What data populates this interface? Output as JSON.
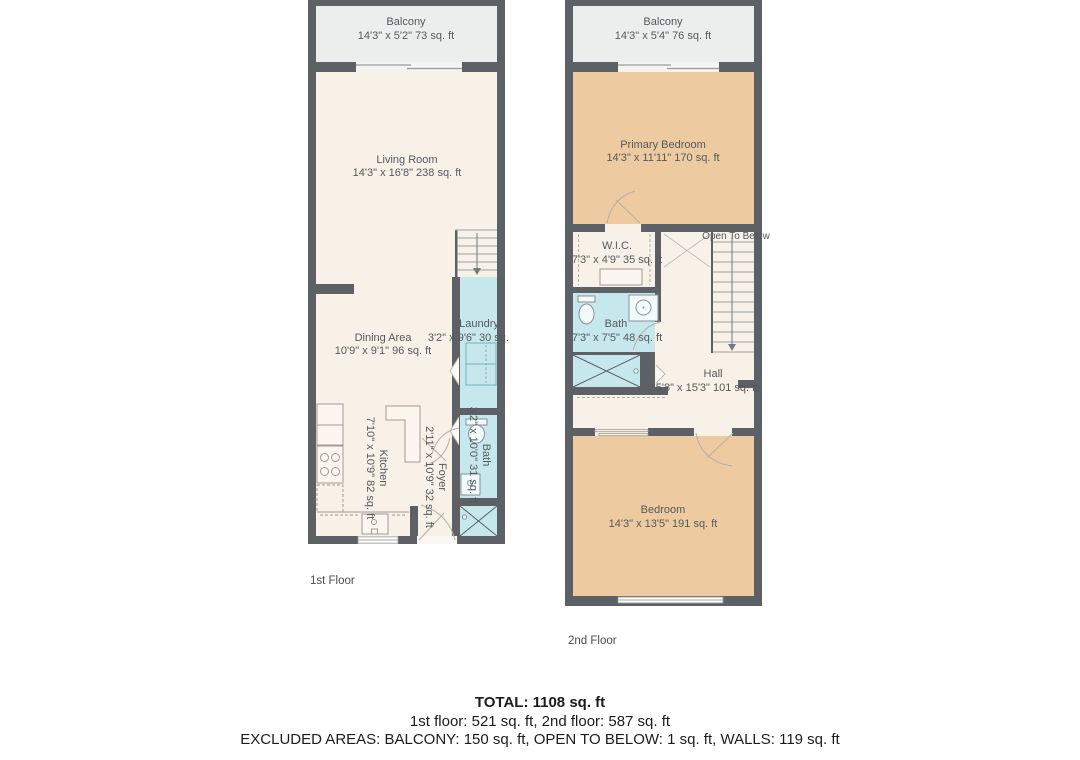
{
  "floors": {
    "first": {
      "caption": "1st Floor",
      "rooms": {
        "balcony": {
          "name": "Balcony",
          "dims": "14'3\" x 5'2\" 73 sq. ft"
        },
        "living": {
          "name": "Living Room",
          "dims": "14'3\" x 16'8\" 238 sq. ft"
        },
        "dining": {
          "name": "Dining Area",
          "dims": "10'9\" x 9'1\" 96 sq. ft"
        },
        "kitchen": {
          "name": "Kitchen",
          "dims": "7'10\" x 10'9\" 82 sq. ft"
        },
        "laundry": {
          "name": "Laundry",
          "dims": "3'2\" x 9'6\" 30 sq. ft"
        },
        "foyer": {
          "name": "Foyer",
          "dims": "2'11\" x 10'9\" 32 sq. ft"
        },
        "bath": {
          "name": "Bath",
          "dims": "3'2\" x 10'0\" 31 sq. ft"
        }
      }
    },
    "second": {
      "caption": "2nd Floor",
      "rooms": {
        "balcony": {
          "name": "Balcony",
          "dims": "14'3\" x 5'4\" 76 sq. ft"
        },
        "primary": {
          "name": "Primary Bedroom",
          "dims": "14'3\" x 11'11\" 170 sq. ft"
        },
        "wic": {
          "name": "W.I.C.",
          "dims": "7'3\" x 4'9\" 35 sq. ft"
        },
        "bath": {
          "name": "Bath",
          "dims": "7'3\" x 7'5\" 48 sq. ft"
        },
        "hall": {
          "name": "Hall",
          "dims": "5'8\" x 15'3\" 101 sq. ft"
        },
        "bedroom": {
          "name": "Bedroom",
          "dims": "14'3\" x 13'5\" 191 sq. ft"
        },
        "open_to_below": {
          "name": "Open To Below"
        }
      }
    }
  },
  "summary": {
    "total": "TOTAL: 1108 sq. ft",
    "floors_line": "1st floor: 521 sq. ft, 2nd floor: 587 sq. ft",
    "excluded_line": "EXCLUDED AREAS: BALCONY: 150 sq. ft, OPEN TO BELOW: 1 sq. ft, WALLS: 119 sq. ft"
  },
  "colors": {
    "wall": "#5d6065",
    "floor": "#f7f1e8",
    "balcony": "#eceded",
    "wet_room": "#c6e7ec",
    "bedroom": "#edca9f"
  }
}
